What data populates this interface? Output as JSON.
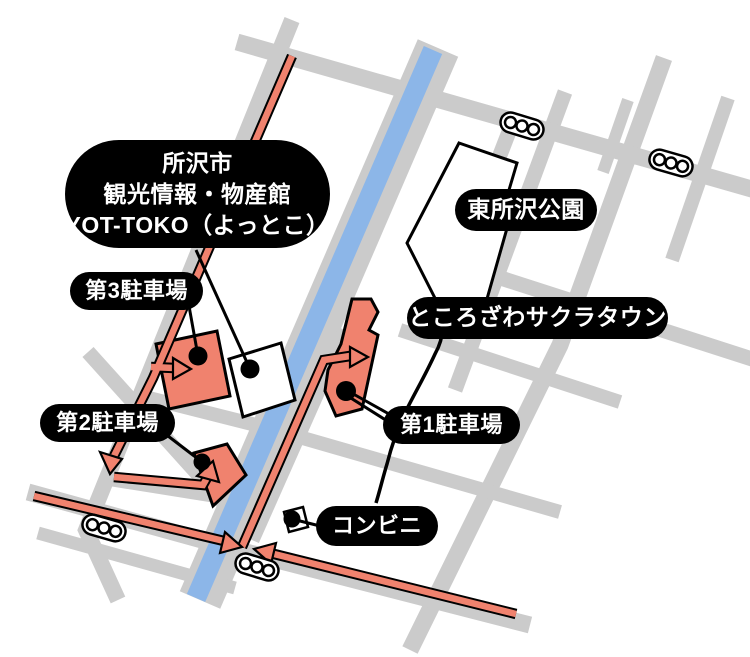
{
  "map_title": "YOT-TOKO parking access map",
  "labels": {
    "main_facility": {
      "line1": "所沢市",
      "line2": "観光情報・物産館",
      "line3": "YOT-TOKO（よっとこ）"
    },
    "park": "東所沢公園",
    "sakura_town": "ところざわサクラタウン",
    "parking3": "第3駐車場",
    "parking2": "第2駐車場",
    "parking1": "第1駐車場",
    "convenience_store": "コンビニ"
  },
  "icons": {
    "traffic_light": {
      "name": "traffic-light-icon",
      "count": 4
    }
  },
  "colors": {
    "road_gray": "#CBCBCB",
    "water_blue": "#8CB6E8",
    "route_salmon": "#F0826E",
    "building_salmon": "#F0826E",
    "label_background": "#000000",
    "label_text": "#FFFFFF",
    "outline_black": "#000000",
    "background": "#FFFFFF"
  },
  "markers": {
    "location_dots": 5,
    "route_arrows": 6
  }
}
